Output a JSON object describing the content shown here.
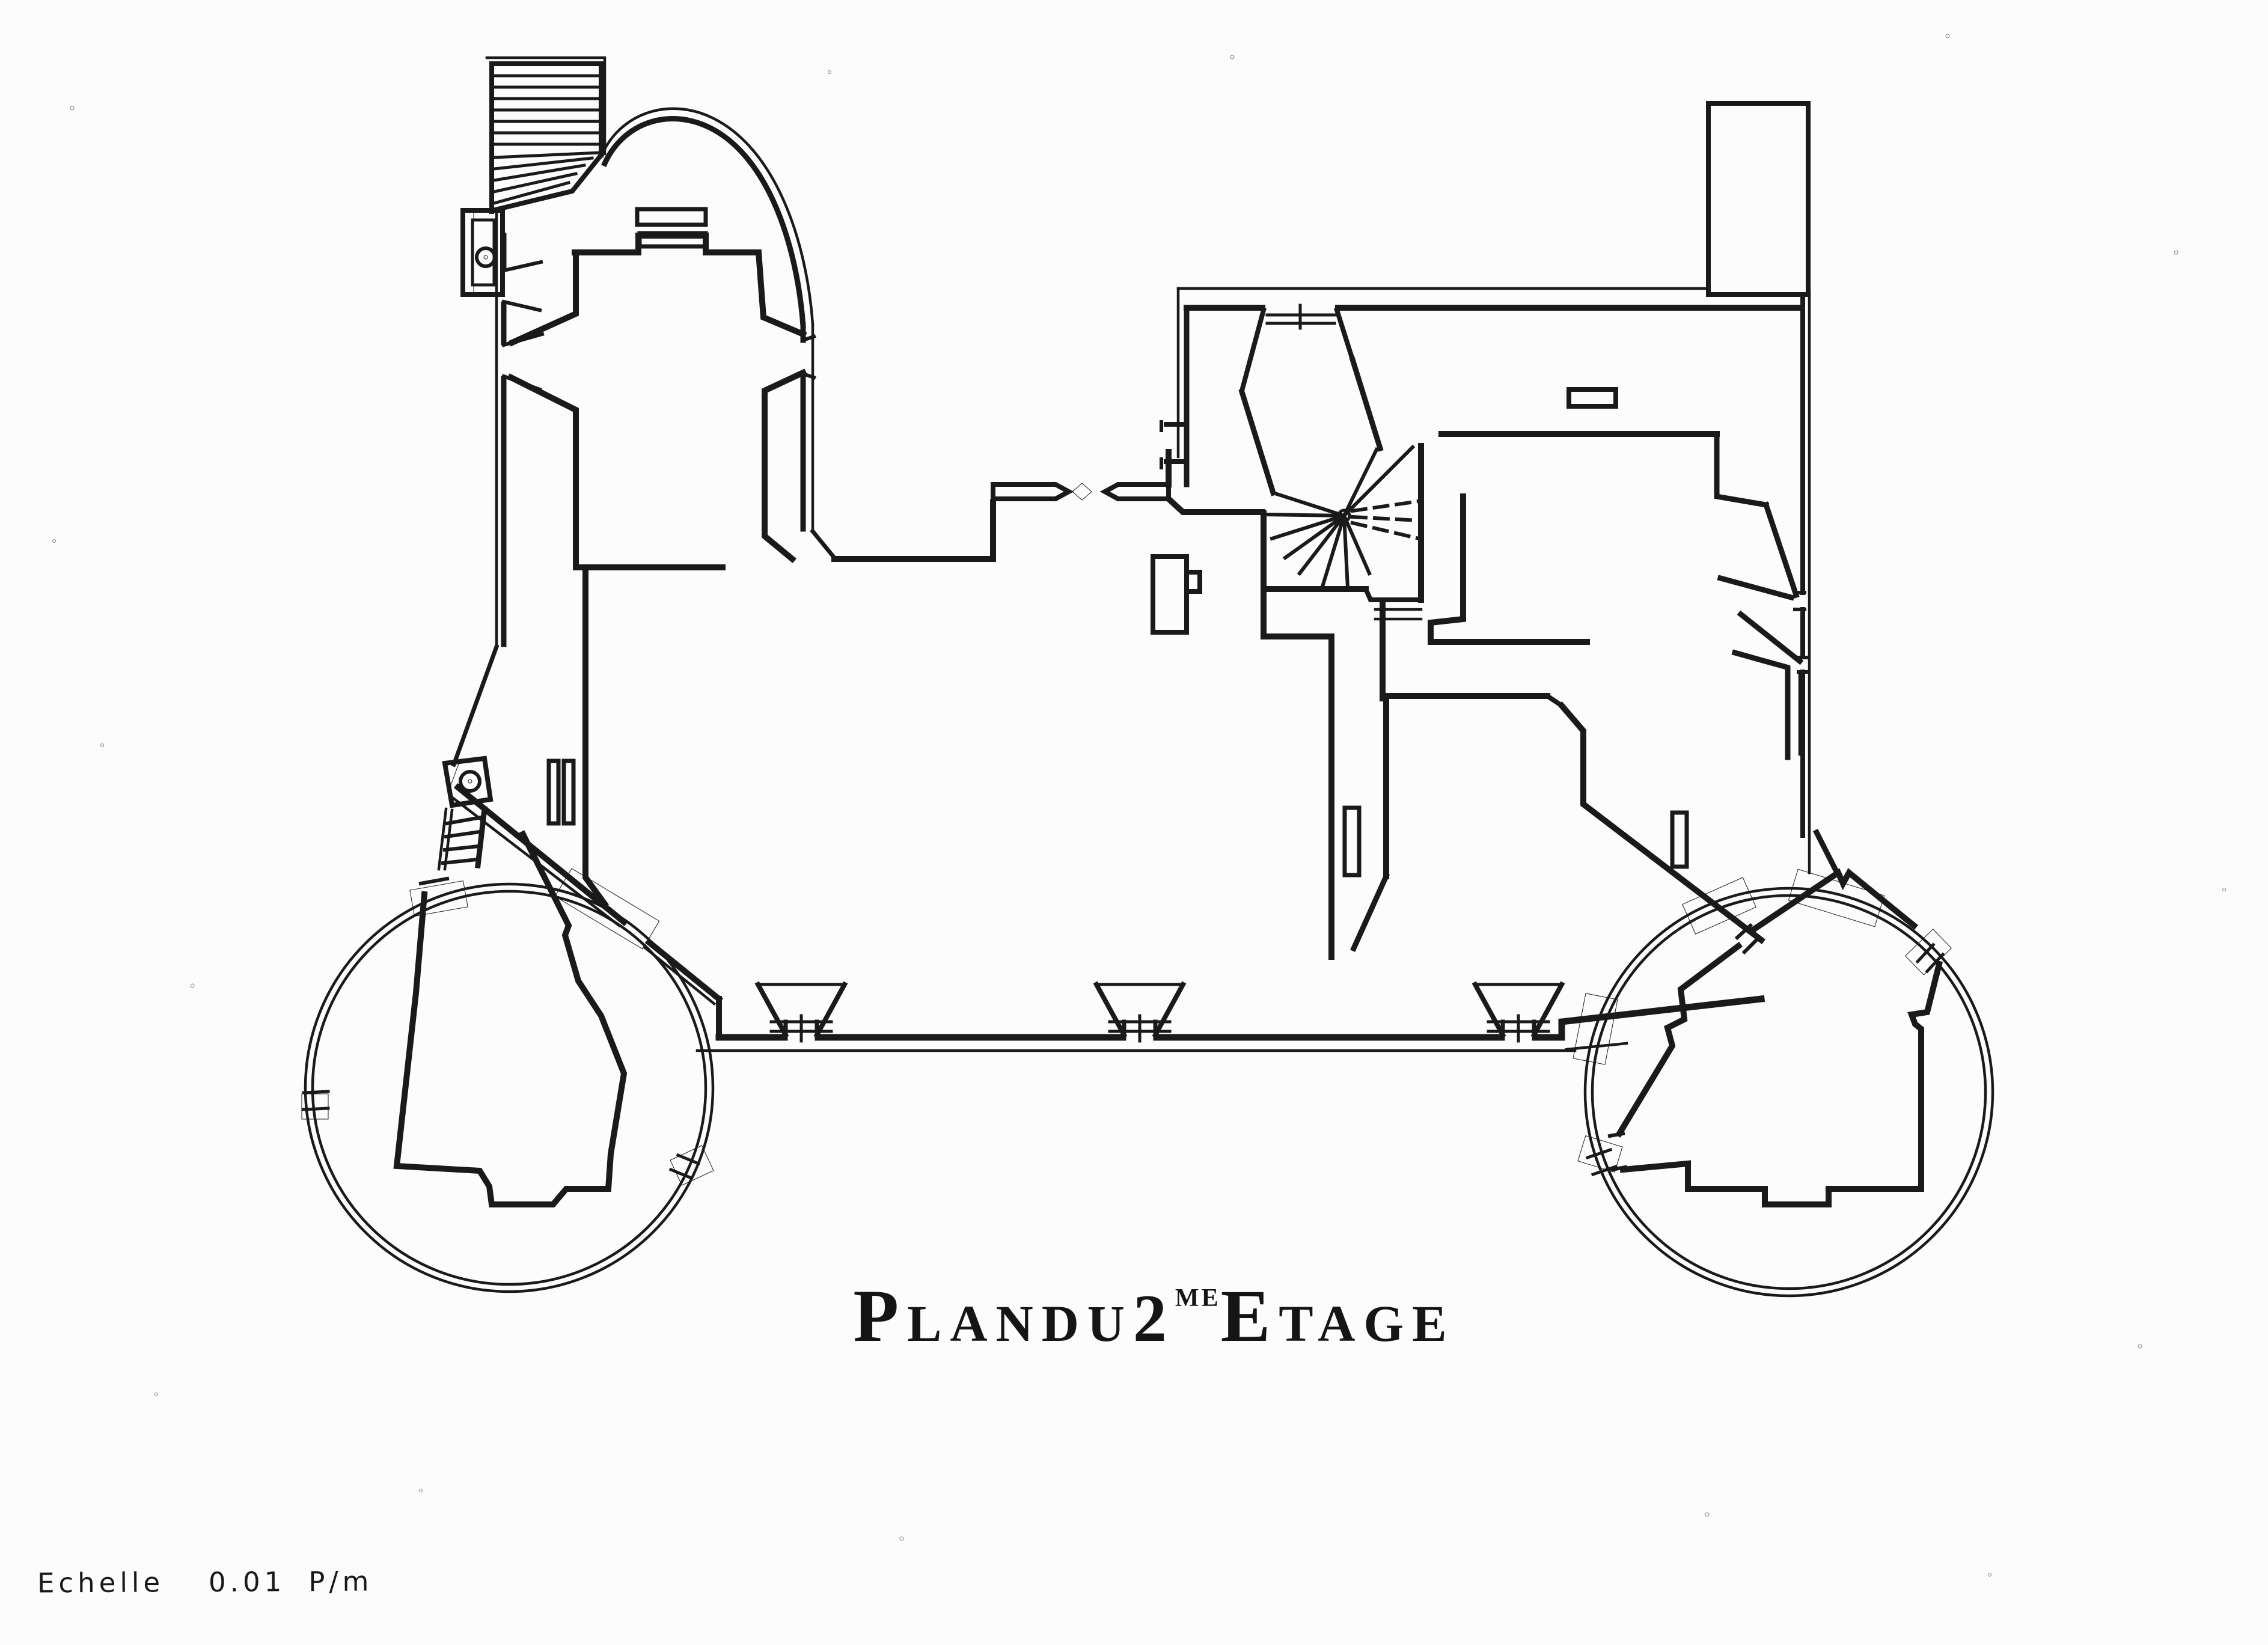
{
  "page": {
    "background": "#fcfcfc",
    "ink": "#1a1a1a"
  },
  "title": {
    "full": "Plan du 2me Etage",
    "initial1": "P",
    "rest1": "lan",
    "word2": "du",
    "number": "2",
    "ordinal": "me",
    "initial3": "E",
    "rest3": "tage"
  },
  "scale_note": {
    "label": "Echelle",
    "value": "0.01",
    "unit": "P/m"
  }
}
